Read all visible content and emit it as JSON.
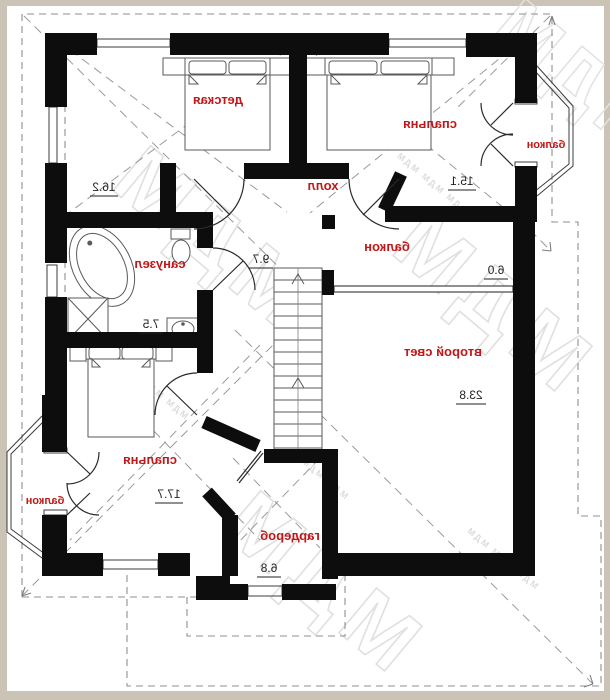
{
  "watermark": {
    "big": "МДМ",
    "small": "МДМ   МДМ   МДМ"
  },
  "rooms": {
    "detskaya": {
      "label": "детская",
      "area": "16.2"
    },
    "spalnya_top": {
      "label": "спальня",
      "area": "15.1"
    },
    "balkon_right": {
      "label": "балкон"
    },
    "holl": {
      "label": "холл",
      "area": "9.7"
    },
    "sanuzel": {
      "label": "санузел",
      "area": "7.5"
    },
    "balkon_inner": {
      "label": "балкон",
      "area": "6.0"
    },
    "vtoroy_svet": {
      "label": "второй свет",
      "area": "23.8"
    },
    "spalnya_bottom": {
      "label": "спальня",
      "area": "17.7"
    },
    "balkon_left": {
      "label": "балкон"
    },
    "garderob": {
      "label": "гардероб",
      "area": "6.8"
    }
  },
  "colors": {
    "label_red": "#c01818",
    "wall_black": "#0d0d0d",
    "dashed_grey": "#8f8f8f",
    "watermark_grey": "#e0e0e0"
  }
}
